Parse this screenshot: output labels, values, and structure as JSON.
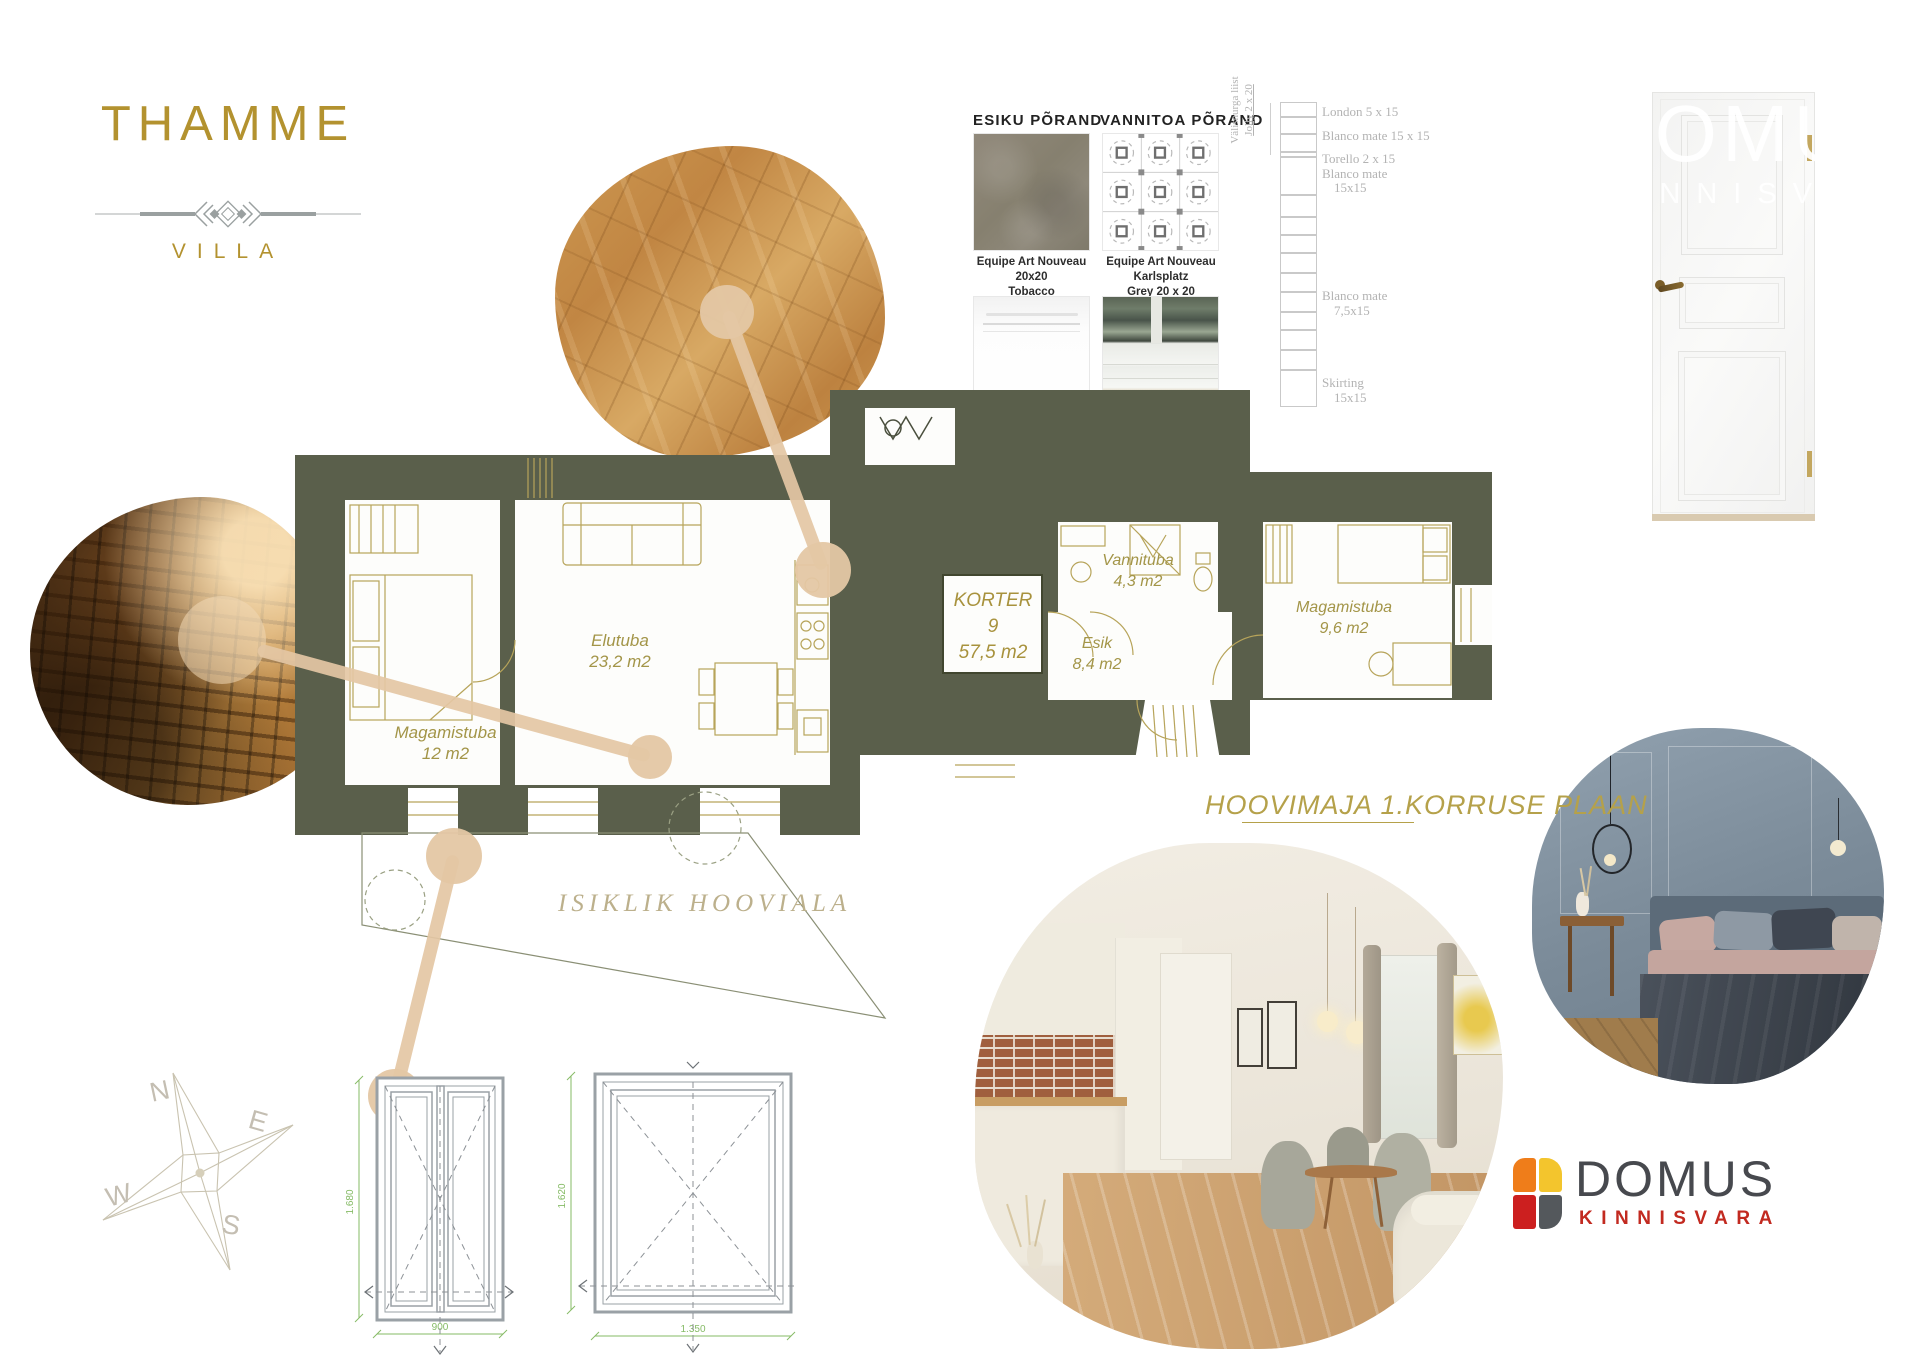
{
  "branding": {
    "title": "THAMME",
    "subtitle": "VILLA"
  },
  "watermark": {
    "line1": "DOMUS",
    "line2": "KINNISVARA"
  },
  "materials": {
    "esiku": {
      "header": "ESIKU PÕRAND",
      "caption1": "Equipe Art Nouveau 20x20",
      "caption2": "Tobacco"
    },
    "vannitoa": {
      "header": "VANNITOA PÕRAND",
      "caption1": "Equipe Art Nouveau Karlsplatz",
      "caption2": "Grey 20 x 20"
    },
    "skirting_white": {
      "caption1": "Equipe Evolution",
      "caption2": "Skirting (alumine rida",
      "caption3": "matt valge"
    },
    "skirting_tile": {
      "caption1": "Equipe Evolution",
      "caption2": "matt valge",
      "caption3": "põhiplaat 7,5 x 15",
      "caption4": "lisaks karniisid"
    }
  },
  "tile_strip": {
    "side_label1": "Välisnurga liist",
    "side_label2": "Jolly 2 x 20",
    "labels": [
      "London 5 x 15",
      "Blanco mate 15 x 15",
      "Torello 2 x 15",
      "Blanco mate",
      "15x15",
      "Blanco mate",
      "7,5x15",
      "Skirting",
      "15x15"
    ]
  },
  "floor_plan": {
    "title": "HOOVIMAJA 1.KORRUSE PLAAN",
    "yard_label": "ISIKLIK  HOOVIALA",
    "apartment": {
      "line1": "KORTER",
      "line2": "9",
      "line3": "57,5 m2"
    },
    "rooms": {
      "living": {
        "name": "Elutuba",
        "area": "23,2 m2"
      },
      "bedroom1": {
        "name": "Magamistuba",
        "area": "12 m2"
      },
      "bathroom": {
        "name": "Vannituba",
        "area": "4,3 m2"
      },
      "hall": {
        "name": "Esik",
        "area": "8,4 m2"
      },
      "bedroom2": {
        "name": "Magamistuba",
        "area": "9,6 m2"
      }
    }
  },
  "windows": {
    "w1_height": "1.680",
    "w1_width": "900",
    "w2_height": "1.620",
    "w2_width": "1.350"
  },
  "compass": {
    "north": "N",
    "east": "E",
    "south": "S",
    "west": "W"
  },
  "agency_logo": {
    "name": "DOMUS",
    "subtitle": "KINNISVARA"
  },
  "colors": {
    "wall": "#5a5f4b",
    "gold": "#b3922f",
    "plan_label": "#a39548",
    "connector": "#e4c7a4",
    "dimension_green": "#86bb66",
    "domus_orange": "#ef7d1a",
    "domus_yellow": "#f3c52d",
    "domus_red": "#cc1f1f",
    "domus_gray": "#54585c",
    "kinnisvara_red": "#c22a20"
  }
}
